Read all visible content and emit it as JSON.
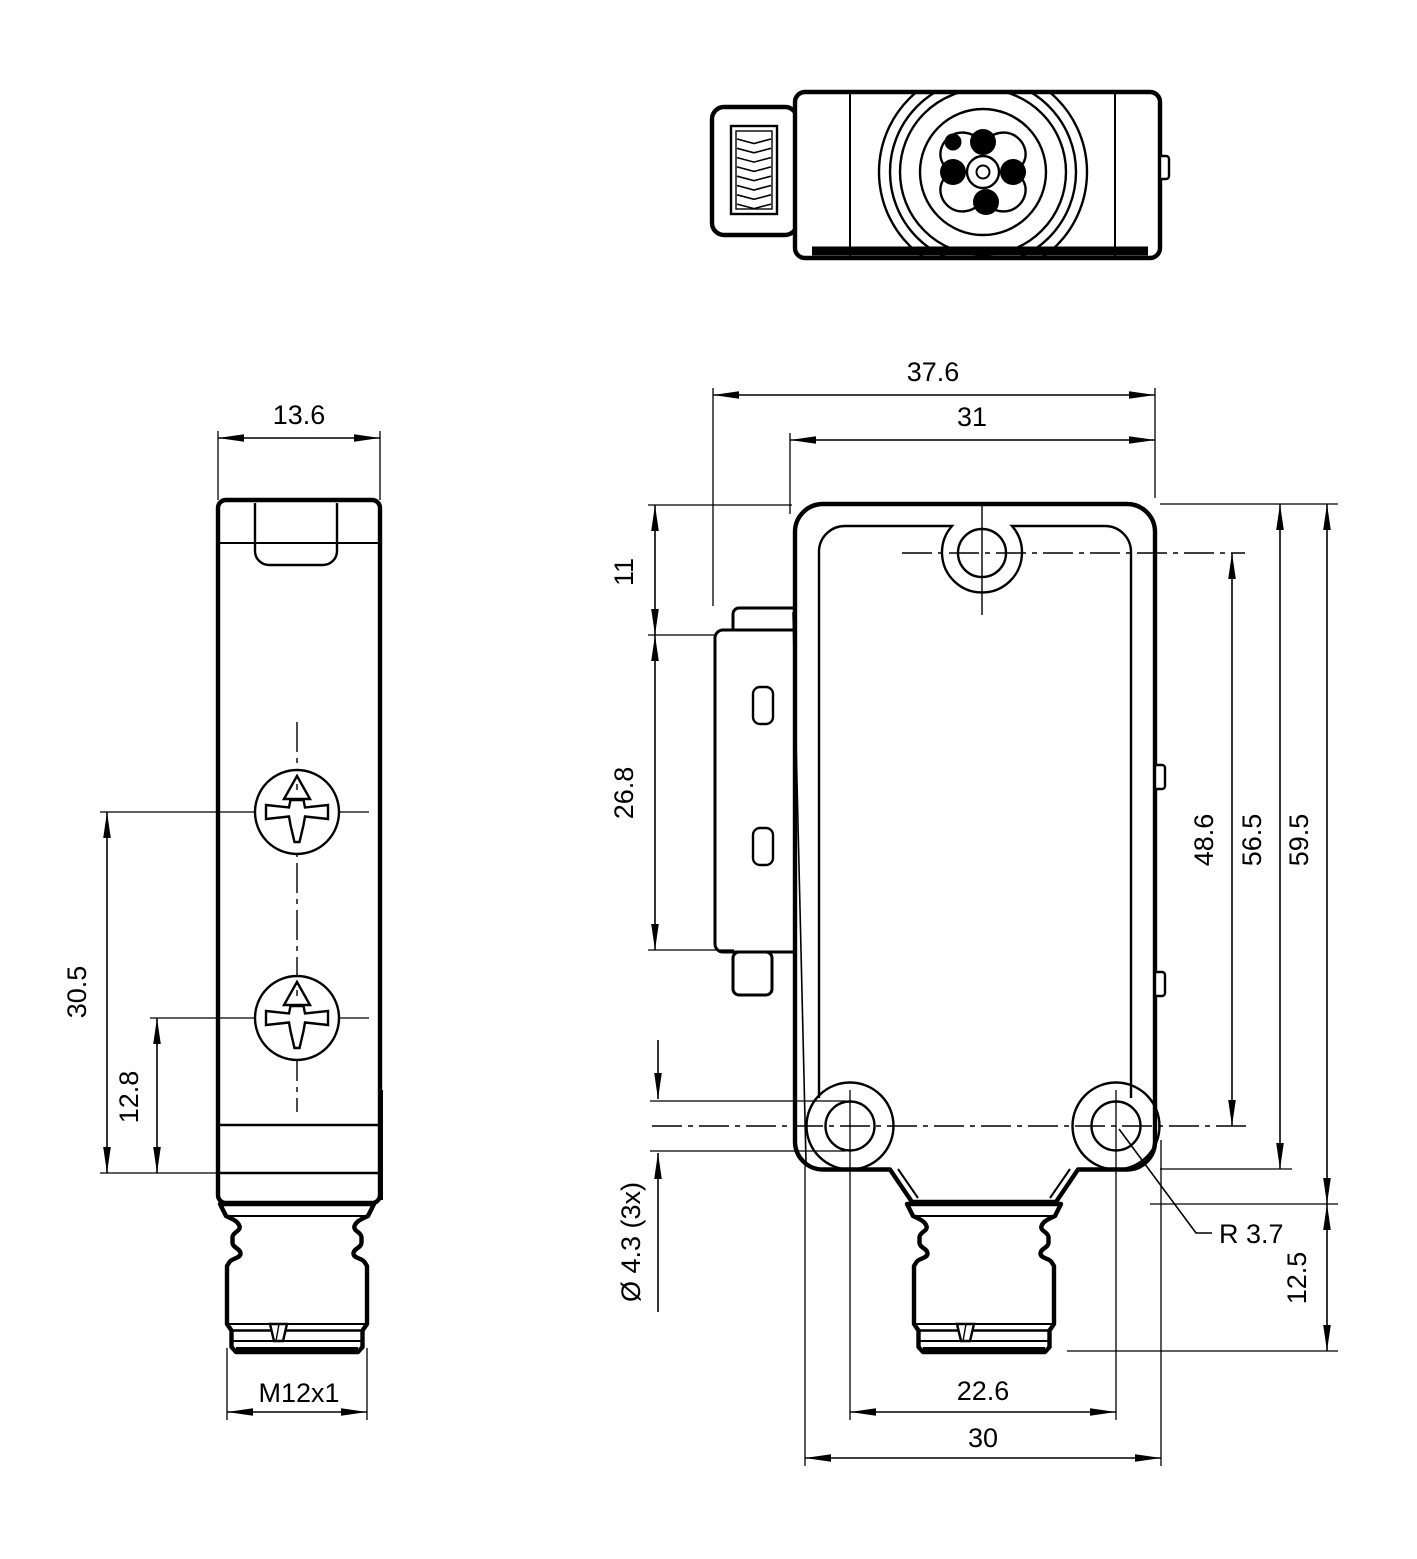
{
  "views": {
    "side": {
      "dims": {
        "width": "13.6",
        "hole_spacing": "30.5",
        "hole_offset": "12.8",
        "thread": "M12x1"
      }
    },
    "front": {
      "dims": {
        "overall_width": "37.6",
        "housing_width": "31",
        "bracket_top_offset": "11",
        "bracket_height": "26.8",
        "hole_diameter": "Ø 4.3 (3x)",
        "hole_center_span": "48.6",
        "housing_length": "56.5",
        "overall_length": "59.5",
        "connector_length": "12.5",
        "bottom_hole_spacing": "22.6",
        "bottom_width": "30",
        "corner_radius": "R 3.7"
      }
    }
  }
}
